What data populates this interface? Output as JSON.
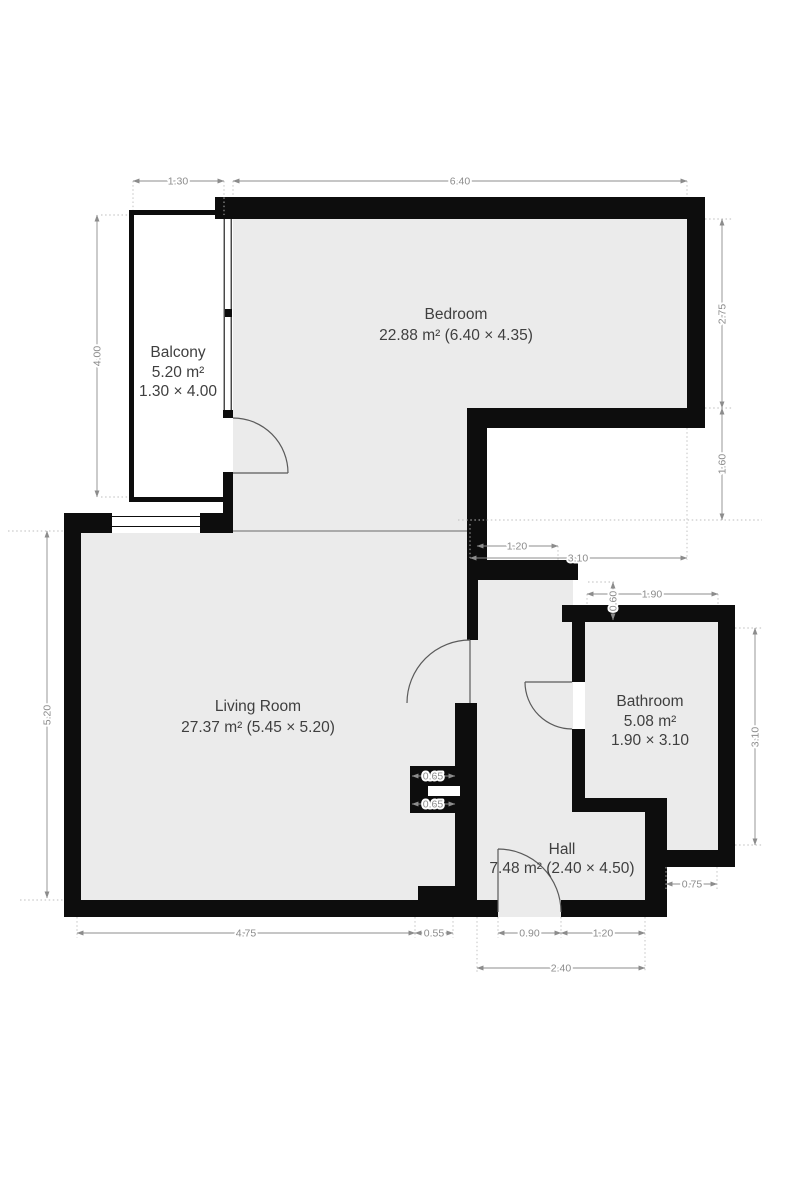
{
  "plan_title": "Apartment floor plan",
  "rooms": {
    "balcony": {
      "name": "Balcony",
      "area": "5.20 m²",
      "dims": "1.30 × 4.00"
    },
    "bedroom": {
      "name": "Bedroom",
      "details": "22.88 m² (6.40 × 4.35)"
    },
    "living": {
      "name": "Living Room",
      "details": "27.37 m² (5.45 × 5.20)"
    },
    "bathroom": {
      "name": "Bathroom",
      "area": "5.08 m²",
      "dims": "1.90 × 3.10"
    },
    "hall": {
      "name": "Hall",
      "details": "7.48 m² (2.40 × 4.50)"
    }
  },
  "dims": {
    "balcony_width": "1.30",
    "bedroom_width": "6.40",
    "balcony_height": "4.00",
    "living_height": "5.20",
    "bedroom_right_height": "2.75",
    "right_gap": "1.60",
    "hall_top_width": "1.20",
    "notch_width": "3.10",
    "bathroom_width": "1.90",
    "bathroom_top_gap": "0.60",
    "bathroom_height": "3.10",
    "bathroom_bottom": "0.75",
    "niche_top": "0.65",
    "niche_bottom": "0.65",
    "living_width": "4.75",
    "living_step": "0.55",
    "entry_width": "0.90",
    "hall_bottom_right": "1.20",
    "hall_width": "2.40"
  },
  "colors": {
    "wall": "#0d0d0d",
    "floor": "#ebebeb",
    "dimension": "#8c8c8c",
    "background": "#ffffff"
  }
}
